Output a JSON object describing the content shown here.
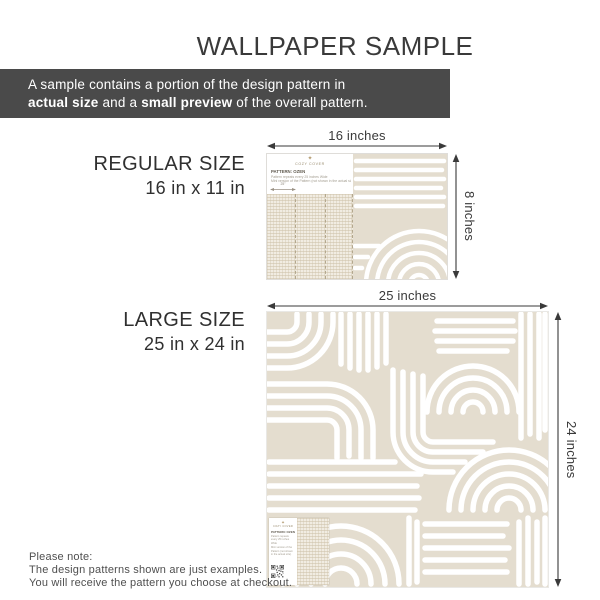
{
  "title": "WALLPAPER SAMPLE",
  "banner": {
    "text1": "A sample contains a portion of the design pattern in",
    "bold1": "actual size",
    "text2": " and a ",
    "bold2": "small preview",
    "text3": " of the overall pattern."
  },
  "regular": {
    "heading": "REGULAR SIZE",
    "size": "16 in x 11 in",
    "width_label": "16 inches",
    "height_label": "8 inches"
  },
  "large": {
    "heading": "LARGE SIZE",
    "size": "25 in x 24 in",
    "width_label": "25 inches",
    "height_label": "24 inches"
  },
  "sample_card": {
    "logo_glyph": "✦",
    "brand": "COZY COVER",
    "pattern_title": "PATTERN: OZEN",
    "detail_line1": "Pattern repeats every 25 inches Wide",
    "detail_line2": "Mini version of the Pattern (not shown in the actual size)",
    "repeat_label": "25\""
  },
  "footer": {
    "line1": "Please note:",
    "line2": "The design patterns shown are just examples.",
    "line3": "You will receive the pattern you choose at checkout."
  },
  "colors": {
    "beige": "#e4ddcf",
    "beige_light": "#f1ece2",
    "banner_bg": "#4a4a4a",
    "text_dark": "#3a3a3a",
    "text_gray": "#565656",
    "arrow": "#3a3a3a",
    "gold": "#b49b70",
    "hatch": "#d9cfba"
  }
}
